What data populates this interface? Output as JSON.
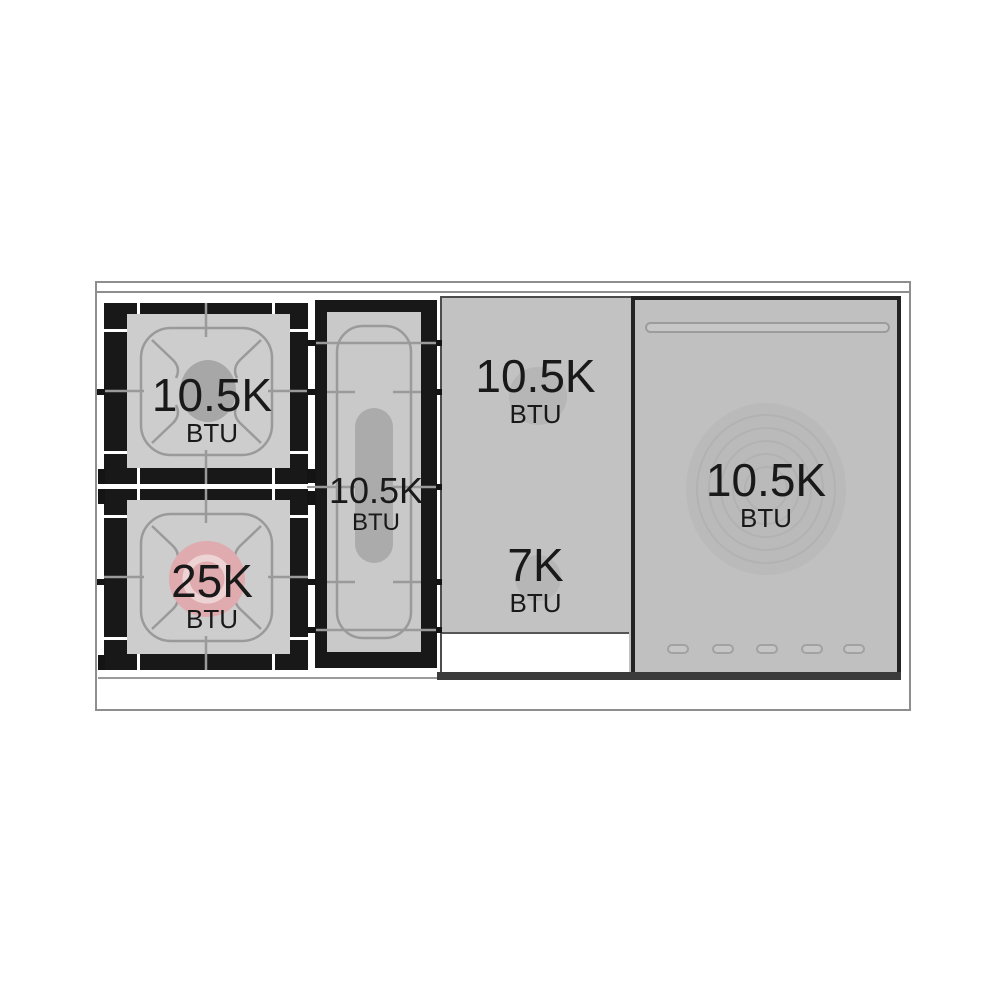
{
  "cooktop": {
    "description": "range cooktop top view with burner power ratings",
    "burners": [
      {
        "id": "left-rear-burner",
        "power": "10.5K",
        "unit": "BTU"
      },
      {
        "id": "left-front-burner",
        "power": "25K",
        "unit": "BTU"
      },
      {
        "id": "center-oval-burner",
        "power": "10.5K",
        "unit": "BTU"
      },
      {
        "id": "griddle-rear-burner",
        "power": "10.5K",
        "unit": "BTU"
      },
      {
        "id": "griddle-front-burner",
        "power": "7K",
        "unit": "BTU"
      },
      {
        "id": "simmer-plate-burner",
        "power": "10.5K",
        "unit": "BTU"
      }
    ],
    "colors": {
      "grate_interior": "#cdcdcd",
      "panel_grey": "#c2c2c2",
      "frame_black": "#181818",
      "burner_grey": "#a7a7a7",
      "accent_pink": "#dfabaf",
      "line_grey": "#9a9a9a",
      "outline_grey": "#8e8e8e"
    }
  }
}
